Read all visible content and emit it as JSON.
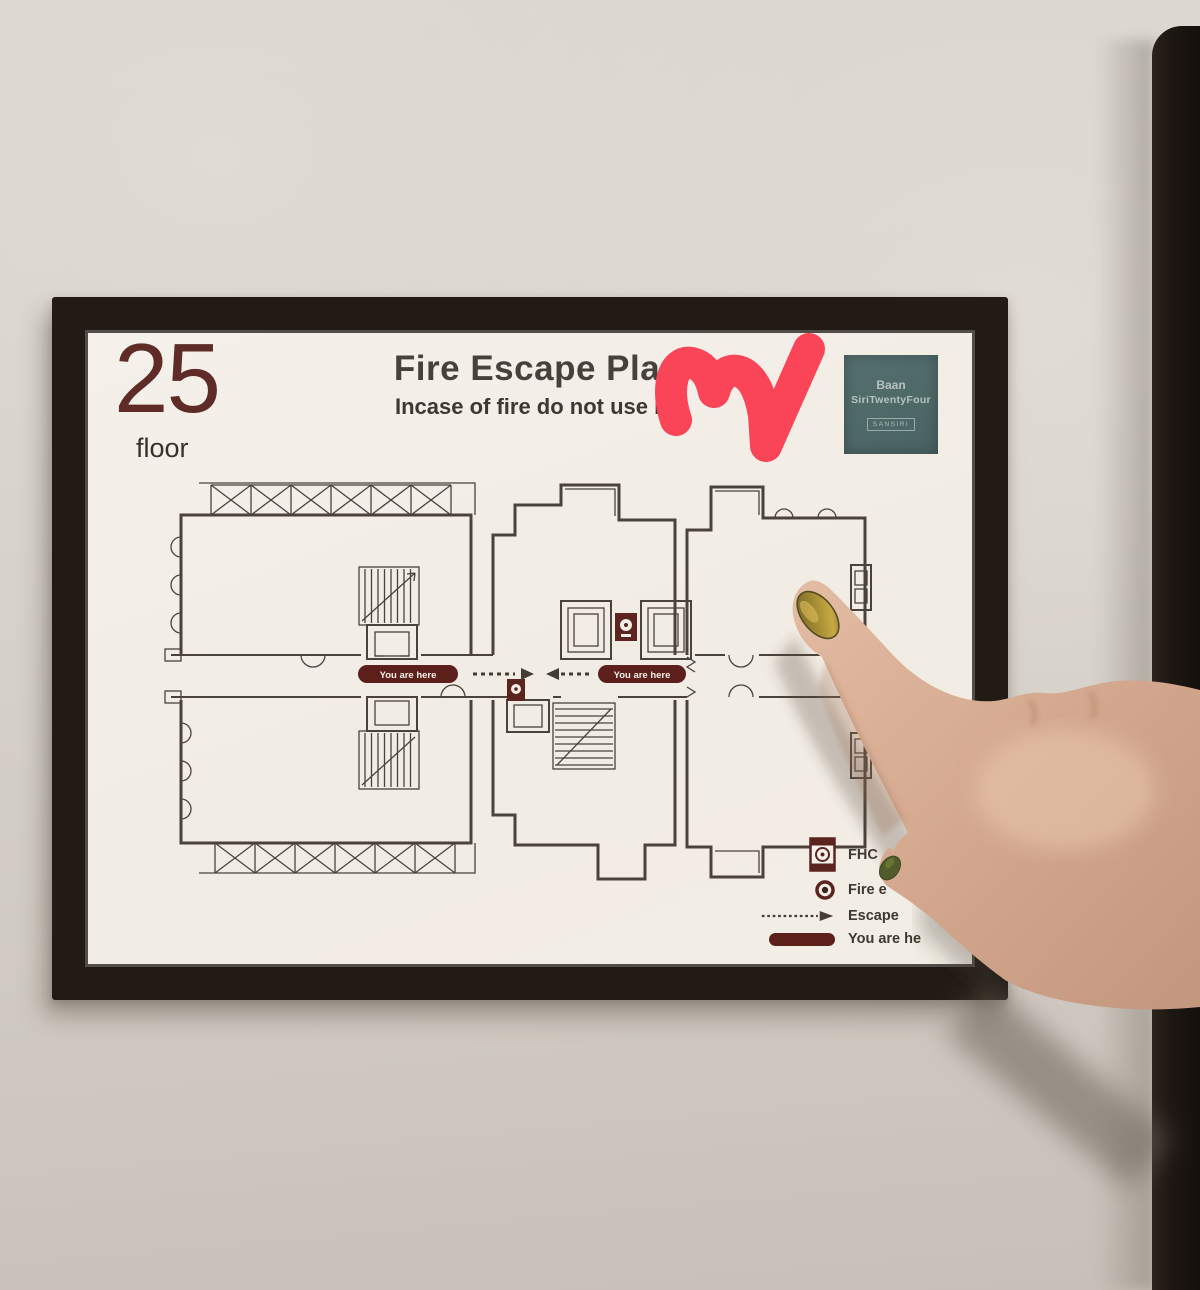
{
  "sign": {
    "floor_number": "25",
    "floor_label": "floor",
    "title": "Fire Escape Plan",
    "subtitle": "Incase of fire do not use lift",
    "logo": {
      "line1": "Baan",
      "line2": "SiriTwentyFour",
      "badge": "SANSIRI"
    },
    "plan": {
      "you_are_here": [
        "You are here",
        "You are here"
      ]
    },
    "legend": {
      "items": [
        {
          "icon": "fhc-icon",
          "label": "FHC"
        },
        {
          "icon": "fire-equipment-icon",
          "label": "Fire e"
        },
        {
          "icon": "escape-route-icon",
          "label": "Escape"
        },
        {
          "icon": "you-are-here-icon",
          "label": "You are he"
        }
      ]
    }
  },
  "colors": {
    "accent_maroon": "#5c241e",
    "plan_line": "#4a423b",
    "heart_pink": "#fa4458",
    "logo_teal": "#50696a",
    "frame_black": "#221b15",
    "nail_olive": "#8a7a35"
  }
}
